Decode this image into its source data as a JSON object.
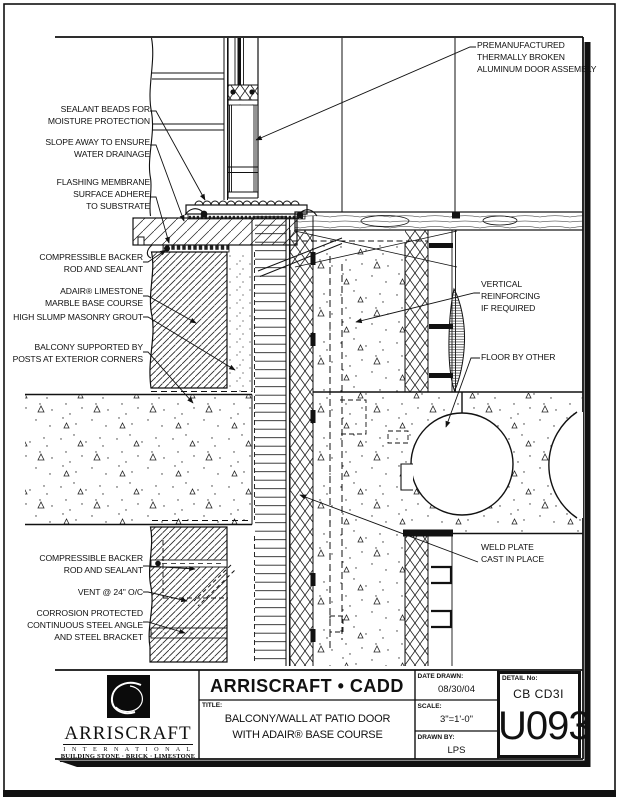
{
  "annotations": {
    "premanufactured": "PREMANUFACTURED\nTHERMALLY BROKEN\nALUMINUM DOOR ASSEMBLY",
    "sealant_beads": "SEALANT BEADS FOR\nMOISTURE PROTECTION",
    "slope_away": "SLOPE AWAY TO ENSURE\nWATER DRAINAGE",
    "flashing_membrane": "FLASHING MEMBRANE\nSURFACE ADHERE\nTO SUBSTRATE",
    "backer_upper": "COMPRESSIBLE BACKER\nROD AND SEALANT",
    "adair": "ADAIR® LIMESTONE\nMARBLE BASE COURSE",
    "grout": "HIGH SLUMP MASONRY GROUT",
    "balcony_posts": "BALCONY SUPPORTED BY\nPOSTS AT EXTERIOR CORNERS",
    "vertical_reinforcing": "VERTICAL\nREINFORCING\nIF REQUIRED",
    "floor_by_other": "FLOOR BY OTHER",
    "weld_plate": "WELD PLATE\nCAST IN PLACE",
    "backer_lower": "COMPRESSIBLE BACKER\nROD AND SEALANT",
    "vent": "VENT @ 24\" O/C",
    "corrosion": "CORROSION PROTECTED\nCONTINUOUS STEEL ANGLE\nAND STEEL BRACKET"
  },
  "title_block": {
    "cadd_header": "ARRISCRAFT • CADD",
    "title_label": "TITLE:",
    "title_line1": "BALCONY/WALL AT PATIO DOOR",
    "title_line2": "WITH ADAIR® BASE COURSE",
    "date_label": "DATE DRAWN:",
    "date_value": "08/30/04",
    "scale_label": "SCALE:",
    "scale_value": "3\"=1'-0\"",
    "drawn_by_label": "DRAWN BY:",
    "drawn_by_value": "LPS",
    "detail_no_label": "DETAIL No:",
    "detail_code": "CB CD3I",
    "detail_number": "U093"
  },
  "logo": {
    "name": "ARRISCRAFT",
    "subtitle": "I N T E R N A T I O N A L",
    "tagline": "BUILDING STONE · BRICK · LIMESTONE"
  },
  "colors": {
    "line": "#111111",
    "paper": "#ffffff"
  }
}
